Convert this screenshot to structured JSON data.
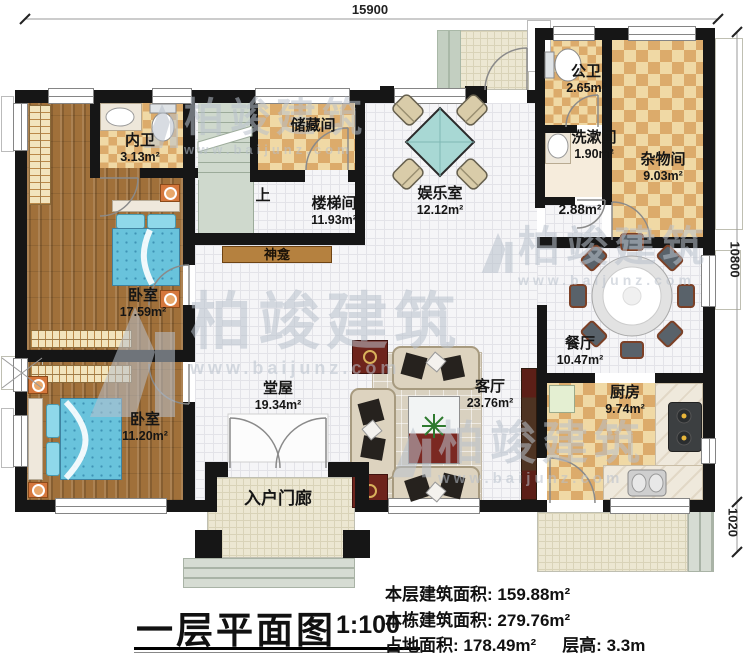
{
  "watermark": {
    "brand": "柏竣建筑",
    "url": "www.baijunz.com"
  },
  "dimensions": {
    "top": "15900",
    "right": "10800",
    "right_lower": "1020"
  },
  "labels": {
    "up": "上",
    "shrine": "神龛"
  },
  "rooms": {
    "neiwei": {
      "name": "内卫",
      "area": "3.13m²"
    },
    "chucangjian": {
      "name": "储藏间"
    },
    "loutijian": {
      "name": "楼梯间",
      "area": "11.93m²"
    },
    "yuleshi": {
      "name": "娱乐室",
      "area": "12.12m²"
    },
    "gongwei": {
      "name": "公卫",
      "area": "2.65m²"
    },
    "xishujian": {
      "name": "洗漱间",
      "area": "1.90m²"
    },
    "zawujian": {
      "name": "杂物间",
      "area": "9.03m²"
    },
    "corridor": {
      "area": "2.88m²"
    },
    "bedroom1": {
      "name": "卧室",
      "area": "17.59m²"
    },
    "canting": {
      "name": "餐厅",
      "area": "10.47m²"
    },
    "tangwu": {
      "name": "堂屋",
      "area": "19.34m²"
    },
    "keting": {
      "name": "客厅",
      "area": "23.76m²"
    },
    "chufang": {
      "name": "厨房",
      "area": "9.74m²"
    },
    "bedroom2": {
      "name": "卧室",
      "area": "11.20m²"
    },
    "porch": {
      "name": "入户门廊"
    }
  },
  "title_block": {
    "title": "一层平面图",
    "scale": "1:100"
  },
  "stats": {
    "line1_label": "本层建筑面积:",
    "line1_value": "159.88m²",
    "line2_label": "本栋建筑面积:",
    "line2_value": "279.76m²",
    "line3a_label": "占地面积:",
    "line3a_value": "178.49m²",
    "line3b_label": "层高:",
    "line3b_value": "3.3m"
  },
  "colors": {
    "wall": "#161616",
    "wood_floor": "#a0703a",
    "checker_light": "#f0d9a5",
    "checker_dark": "#dcab6b",
    "stair_green": "#cfd9cd",
    "bed_blue": "#69c3dc",
    "shrine_wood": "#b5813f"
  }
}
